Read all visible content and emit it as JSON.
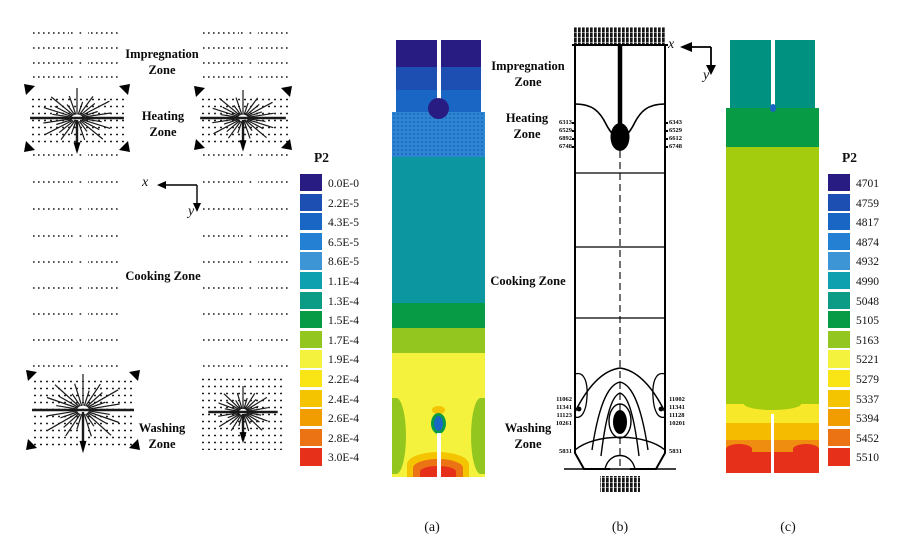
{
  "axes": {
    "x": "x",
    "y": "y"
  },
  "zones": {
    "impregnation": "Impregnation\nZone",
    "heating": "Heating\nZone",
    "cooking": "Cooking Zone",
    "washing": "Washing\nZone"
  },
  "captions": {
    "a": "(a)",
    "b": "(b)",
    "c": "(c)"
  },
  "legend_a": {
    "title": "P2",
    "entries": [
      {
        "label": "0.0E-0",
        "color": "#281c83"
      },
      {
        "label": "2.2E-5",
        "color": "#1d4fb3"
      },
      {
        "label": "4.3E-5",
        "color": "#1a66c5"
      },
      {
        "label": "6.5E-5",
        "color": "#2380d2"
      },
      {
        "label": "8.6E-5",
        "color": "#3d95d6"
      },
      {
        "label": "1.1E-4",
        "color": "#0fa0b0"
      },
      {
        "label": "1.3E-4",
        "color": "#0c9c86"
      },
      {
        "label": "1.5E-4",
        "color": "#089b45"
      },
      {
        "label": "1.7E-4",
        "color": "#93c71f"
      },
      {
        "label": "1.9E-4",
        "color": "#f4f23c"
      },
      {
        "label": "2.2E-4",
        "color": "#f9e416"
      },
      {
        "label": "2.4E-4",
        "color": "#f5c400"
      },
      {
        "label": "2.6E-4",
        "color": "#f19d00"
      },
      {
        "label": "2.8E-4",
        "color": "#ec7314"
      },
      {
        "label": "3.0E-4",
        "color": "#e73019"
      }
    ]
  },
  "legend_c": {
    "title": "P2",
    "entries": [
      {
        "label": "4701",
        "color": "#281c83"
      },
      {
        "label": "4759",
        "color": "#1d4fb3"
      },
      {
        "label": "4817",
        "color": "#1a66c5"
      },
      {
        "label": "4874",
        "color": "#2380d2"
      },
      {
        "label": "4932",
        "color": "#3d95d6"
      },
      {
        "label": "4990",
        "color": "#0fa0b0"
      },
      {
        "label": "5048",
        "color": "#0c9c86"
      },
      {
        "label": "5105",
        "color": "#089b45"
      },
      {
        "label": "5163",
        "color": "#93c71f"
      },
      {
        "label": "5221",
        "color": "#f4f23c"
      },
      {
        "label": "5279",
        "color": "#f9e416"
      },
      {
        "label": "5337",
        "color": "#f5c400"
      },
      {
        "label": "5394",
        "color": "#f19d00"
      },
      {
        "label": "5452",
        "color": "#ec7314"
      },
      {
        "label": "5510",
        "color": "#e73019"
      }
    ]
  },
  "panel_b": {
    "heating_ticks_left": [
      "6313",
      "6529",
      "6892",
      "6748"
    ],
    "heating_ticks_right": [
      "6343",
      "6529",
      "6612",
      "6748"
    ],
    "washing_ticks_left": [
      "11062",
      "11341",
      "11123",
      "10261"
    ],
    "washing_ticks_right": [
      "11002",
      "11341",
      "11128",
      "10201"
    ],
    "bottom_tick_left": "5831",
    "bottom_tick_right": "5831"
  },
  "chart_data": [
    {
      "type": "heatmap",
      "panel": "(a)",
      "legend_title": "P2",
      "legend_levels": [
        "0.0E-0",
        "2.2E-5",
        "4.3E-5",
        "6.5E-5",
        "8.6E-5",
        "1.1E-4",
        "1.3E-4",
        "1.5E-4",
        "1.7E-4",
        "1.9E-4",
        "2.2E-4",
        "2.4E-4",
        "2.6E-4",
        "2.8E-4",
        "3.0E-4"
      ],
      "zones": [
        "Impregnation Zone",
        "Heating Zone",
        "Cooking Zone",
        "Washing Zone"
      ],
      "description": "Filled contour column: navy/blue low values at top impregnation-heating zones, teal-green mid column, yellow cooking-washing region with green side lobes and orange-red maximum at bottom outlet"
    },
    {
      "type": "contour",
      "panel": "(b)",
      "contour_labels_heating": [
        "6313",
        "6529",
        "6892",
        "6748",
        "6343",
        "6612"
      ],
      "contour_labels_washing": [
        "11062",
        "11341",
        "11123",
        "10261",
        "11002",
        "11128",
        "10201",
        "5831"
      ],
      "zones": [
        "Impregnation Zone",
        "Heating Zone",
        "Cooking Zone",
        "Washing Zone"
      ]
    },
    {
      "type": "heatmap",
      "panel": "(c)",
      "legend_title": "P2",
      "legend_levels": [
        4701,
        4759,
        4817,
        4874,
        4932,
        4990,
        5048,
        5105,
        5163,
        5221,
        5279,
        5337,
        5394,
        5452,
        5510
      ],
      "description": "Filled contour column: teal top, dark green band, large yellow-green middle, yellow/amber/orange/red stratified bottom"
    }
  ]
}
